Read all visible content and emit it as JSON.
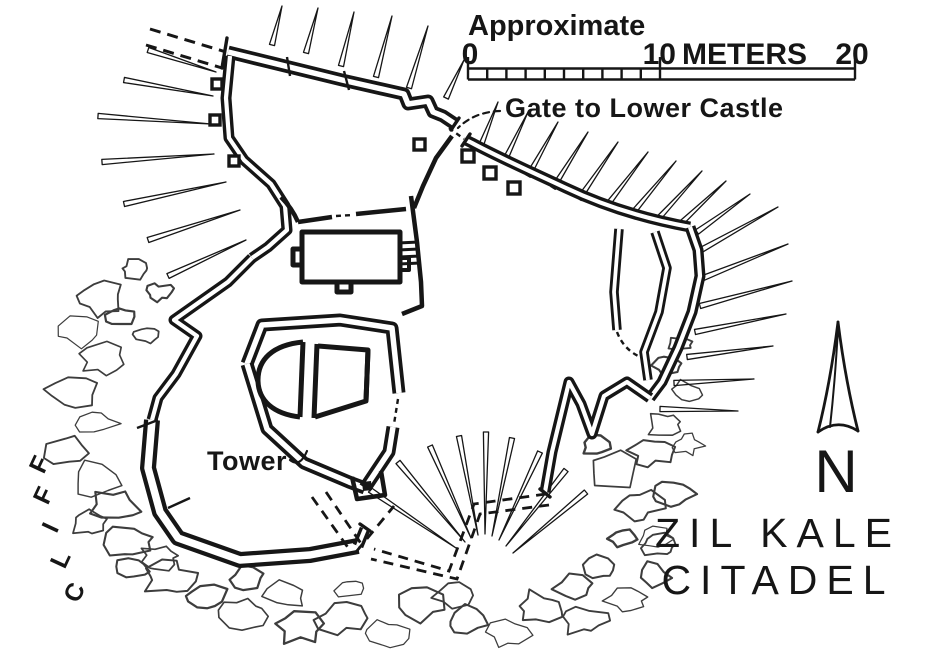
{
  "map": {
    "scale_heading": "Approximate",
    "scale": {
      "start": "0",
      "mid": "10",
      "unit": "METERS",
      "end": "20"
    },
    "gate_label": "Gate to Lower Castle",
    "tower_label": "Tower",
    "cliff_label": "CLIFF",
    "cliff_letters": [
      "C",
      "L",
      "I",
      "F",
      "F"
    ],
    "north_letter": "N",
    "title_line1": "ZIL KALE",
    "title_line2": "CITADEL",
    "colors": {
      "ink": "#161616",
      "paper": "#ffffff",
      "rock": "#3d3d3d"
    }
  }
}
